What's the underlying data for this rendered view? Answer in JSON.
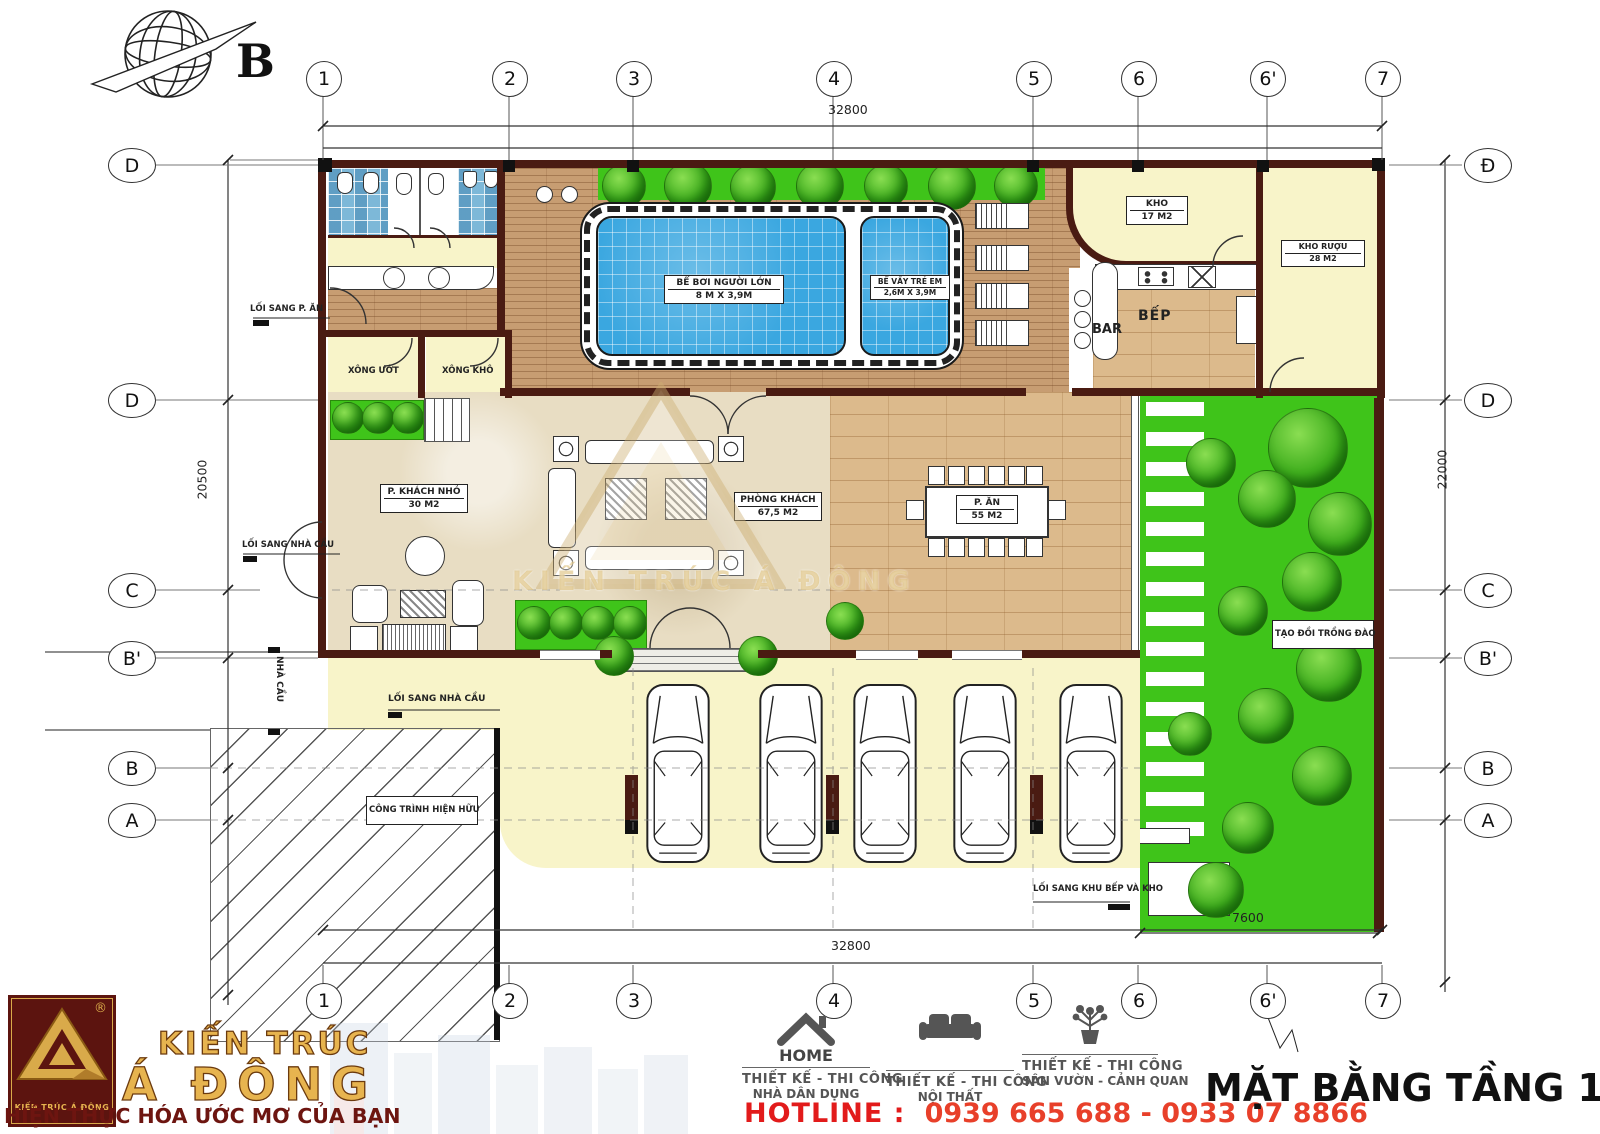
{
  "north": {
    "letter": "B"
  },
  "grid": {
    "cols": [
      "1",
      "2",
      "3",
      "4",
      "5",
      "6",
      "6'",
      "7"
    ],
    "rows_left": [
      "D",
      "D",
      "C",
      "B'",
      "B",
      "A"
    ],
    "rows_right": [
      "Đ",
      "D",
      "C",
      "B'",
      "B",
      "A"
    ],
    "dims": {
      "top": "32800",
      "bottom": "32800",
      "left": "20500",
      "right": "22000",
      "garden": "7600"
    }
  },
  "labels": {
    "pool_main_name": "BỂ BƠI NGƯỜI LỚN",
    "pool_main_size": "8 M X 3,9M",
    "pool_kids_name": "BỂ VẦY TRẺ EM",
    "pool_kids_size": "2,6M X 3,9M",
    "kho_name": "KHO",
    "kho_size": "17 M2",
    "kho_ruou_name": "KHO RƯỢU",
    "kho_ruou_size": "28 M2",
    "bep": "BẾP",
    "bar": "BAR",
    "xong_uot": "XÔNG ƯỚT",
    "xong_kho": "XÔNG KHÔ",
    "p_khach_nho_name": "P. KHÁCH NHỎ",
    "p_khach_nho_size": "30 M2",
    "phong_khach_name": "PHÒNG KHÁCH",
    "phong_khach_size": "67,5 M2",
    "p_an_name": "P. ĂN",
    "p_an_size": "55 M2",
    "tao_doi": "TẠO ĐỒI TRỒNG ĐÀO",
    "cong_trinh": "CÔNG TRÌNH HIỆN HỮU",
    "nha_cau": "NHÀ CẦU",
    "loi_sang_p_an": "LỐI SANG P. ĂN",
    "loi_sang_nha_cau_top": "LỐI SANG NHÀ CẦU",
    "loi_sang_nha_cau_bottom": "LỐI SANG NHÀ CẦU",
    "loi_sang_khu_bep": "LỐI SANG KHU BẾP VÀ KHO"
  },
  "watermark": {
    "text": "KIẾN TRÚC Á ĐÔNG"
  },
  "footer": {
    "logo_text": "KIẾN TRÚC Á ĐÔNG",
    "reg": "®",
    "brand_line1": "KIẾN TRÚC",
    "brand_line2": "Á ĐÔNG",
    "slogan": "HIỆN THỰC HÓA ƯỚC MƠ CỦA BẠN",
    "services": [
      {
        "icon": "house-icon",
        "title": "HOME",
        "line1": "THIẾT KẾ - THI CÔNG",
        "line2": "NHÀ DÂN DỤNG"
      },
      {
        "icon": "sofa-icon",
        "title": "",
        "line1": "THIẾT KẾ - THI CÔNG",
        "line2": "NỘI THẤT"
      },
      {
        "icon": "plant-icon",
        "title": "",
        "line1": "THIẾT KẾ - THI CÔNG",
        "line2": "SÂN VƯỜN - CẢNH QUAN"
      }
    ],
    "hotline_label": "HOTLINE :",
    "hotline_numbers": "0939 665 688 - 0933 07 8866"
  },
  "title": "MẶT BẰNG TẦNG 1",
  "colors": {
    "wall": "#4a1b12",
    "water": "#3aa7e0",
    "garden_green": "#3fc41a",
    "room_yellow": "#f8f4c9",
    "deck_wood": "#c79d72",
    "floor_wood": "#dcba8c",
    "marble": "#e8ddc3",
    "brand_gold": "#e7b44f",
    "brand_maroon": "#5c140f",
    "hotline_red": "#e21b1b"
  }
}
